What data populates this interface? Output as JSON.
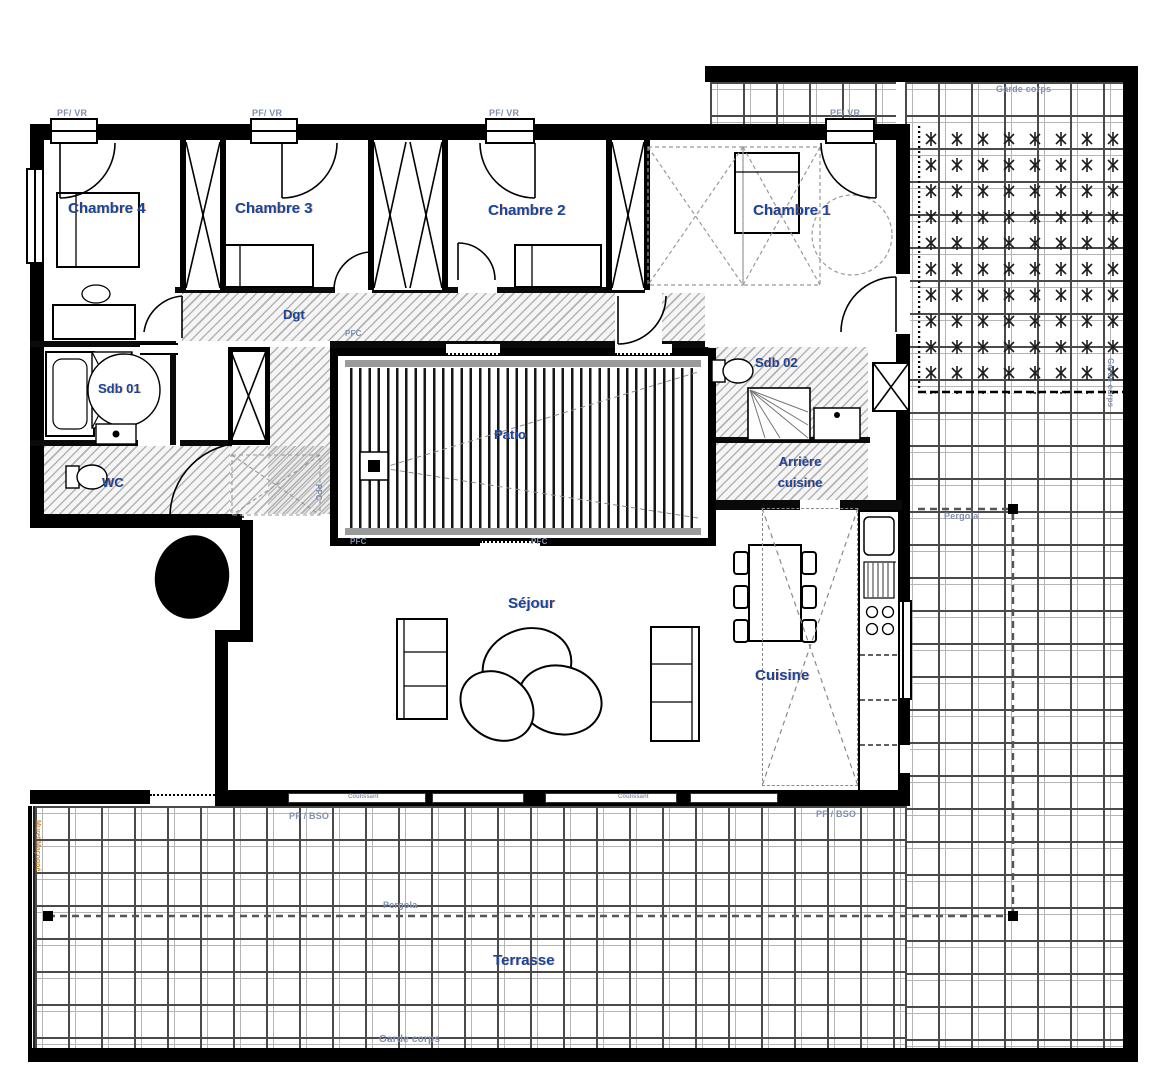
{
  "plan_title": "Floor plan - apartment with terrace",
  "rooms": {
    "chambre4": "Chambre 4",
    "chambre3": "Chambre 3",
    "chambre2": "Chambre 2",
    "chambre1": "Chambre 1",
    "dgt": "Dgt",
    "sdb01": "Sdb 01",
    "wc": "WC",
    "patio": "Patio",
    "sdb02": "Sdb 02",
    "arriere_cuisine": "Arrière cuisine",
    "sejour": "Séjour",
    "cuisine": "Cuisine",
    "terrasse": "Terrasse"
  },
  "annotations": {
    "pf_vr": "PF/ VR",
    "pf_bso": "PF / BSO",
    "pfc": "PFC",
    "garde_corps": "Garde corps",
    "pergola": "Pergola",
    "coulissant": "Coulissant",
    "muret": "Muret Maçonné"
  },
  "colors": {
    "wall": "#000000",
    "room_label": "#17469e",
    "annotation_label": "#7f8fb0",
    "hatch": "#7d7d7d"
  }
}
